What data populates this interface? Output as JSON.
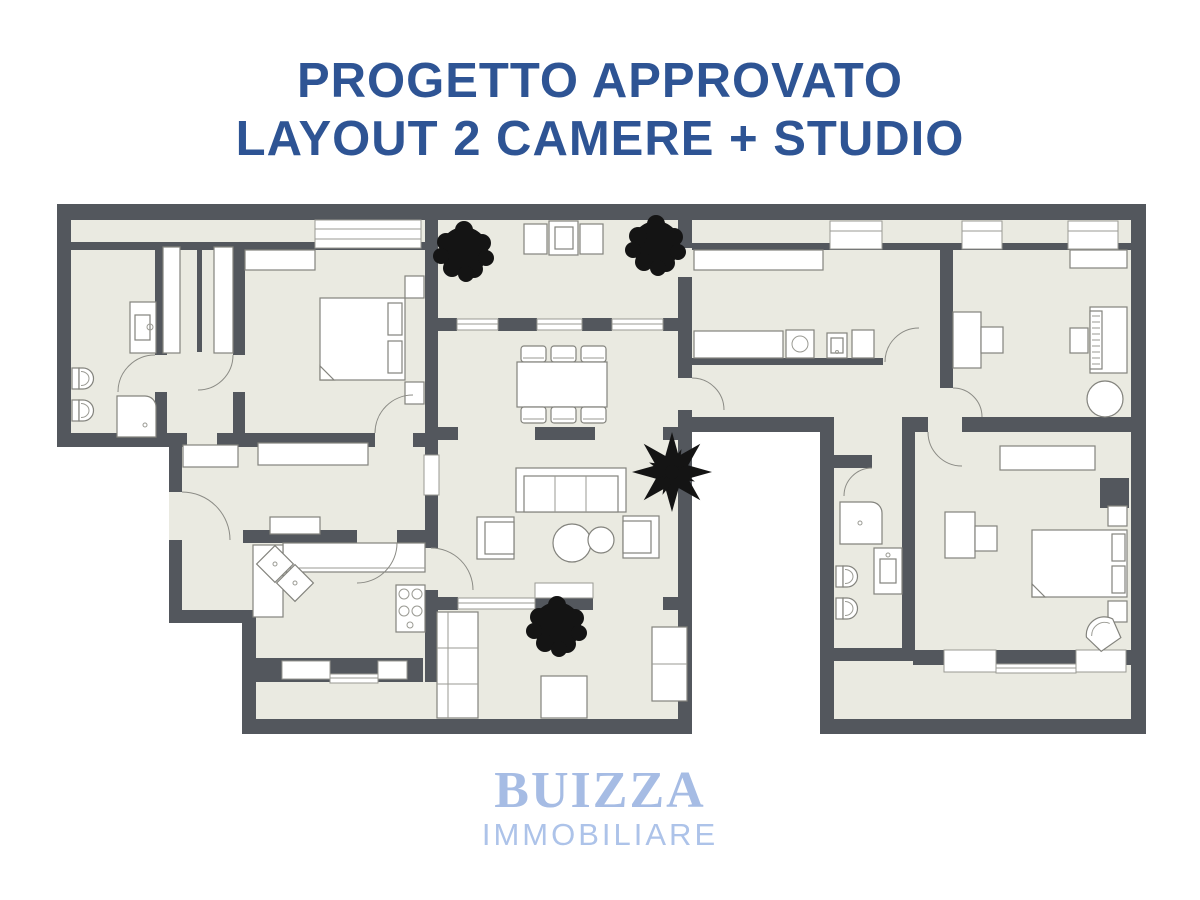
{
  "page": {
    "background": "#ffffff"
  },
  "title": {
    "line1": "PROGETTO APPROVATO",
    "line2": "LAYOUT 2 CAMERE + STUDIO",
    "color": "#2e5494"
  },
  "logo": {
    "brand": "BUIZZA",
    "subtitle": "IMMOBILIARE",
    "brand_color": "#a6bce4",
    "subtitle_color": "#adc3e9"
  },
  "floorplan": {
    "type": "apartment-floor-plan",
    "colors": {
      "wall": "#53575d",
      "floor": "#eaeae1",
      "furniture_fill": "#ffffff",
      "furniture_stroke": "#83837d",
      "plant": "#141414"
    },
    "rooms": [
      "bathroom-left",
      "walk-in-closets",
      "bedroom-1",
      "entrance-hall",
      "kitchen",
      "dining-room",
      "living-room",
      "north-balcony",
      "south-balcony",
      "courtyard-cutout",
      "laundry-corridor",
      "studio",
      "bedroom-2",
      "bathroom-right",
      "south-east-balcony"
    ],
    "icons": [
      "tree-icon",
      "star-plant-icon",
      "double-bed-icon",
      "sofa-icon",
      "dining-table-icon",
      "chair-icon",
      "armchair-icon",
      "coffee-table-icon",
      "desk-icon",
      "piano-icon",
      "round-table-icon",
      "wardrobe-icon",
      "toilet-icon",
      "bidet-icon",
      "shower-icon",
      "sink-icon",
      "gas-hob-icon",
      "washing-machine-icon",
      "kitchen-counter-icon",
      "door-swing-icon",
      "window-icon"
    ]
  }
}
